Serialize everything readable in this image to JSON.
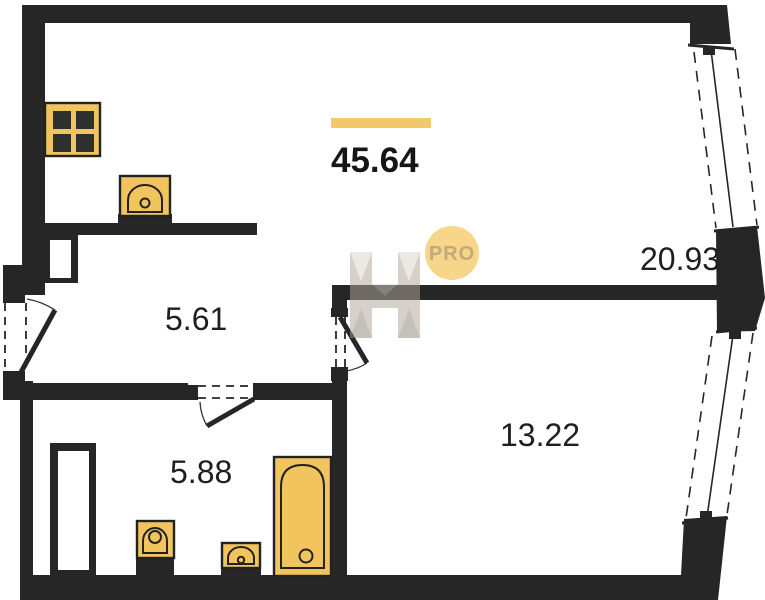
{
  "plan": {
    "title_total_area": {
      "value": "45.64"
    },
    "rooms": [
      {
        "id": "living-kitchen",
        "area": "20.93"
      },
      {
        "id": "hallway",
        "area": "5.61"
      },
      {
        "id": "bathroom",
        "area": "5.88"
      },
      {
        "id": "bedroom",
        "area": "13.22"
      }
    ],
    "badge": {
      "label": "PRO"
    },
    "fixtures": [
      "stove-icon",
      "kitchen-sink-icon",
      "toilet-icon",
      "wash-basin-icon",
      "bathtub-icon"
    ],
    "windows": [
      "window-upper-right",
      "window-lower-right"
    ],
    "doors": [
      "entry-door",
      "bathroom-door",
      "bedroom-door"
    ]
  },
  "colors": {
    "wall": "#262626",
    "fixture": "#f2c45e",
    "accent_bar": "#f3c869",
    "badge_fill": "#f7d689",
    "badge_text": "#c2aa79",
    "watermark": "#b0a99a",
    "label_text": "#1f1f1f"
  }
}
